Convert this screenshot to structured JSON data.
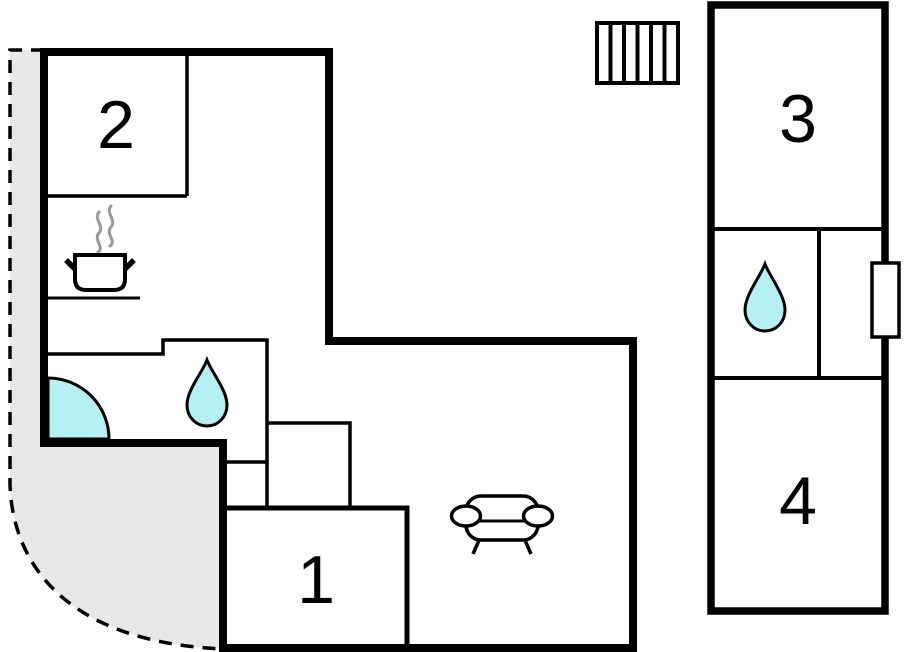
{
  "floorplan": {
    "kind": "vacation-home-floor-plan",
    "rooms": [
      {
        "id": "room-1",
        "label": "1"
      },
      {
        "id": "room-2",
        "label": "2"
      },
      {
        "id": "room-3",
        "label": "3"
      },
      {
        "id": "room-4",
        "label": "4"
      }
    ],
    "icons": [
      {
        "name": "stove-pot-icon"
      },
      {
        "name": "steam-icon"
      },
      {
        "name": "kitchen-counter-line"
      },
      {
        "name": "water-drop-icon-main"
      },
      {
        "name": "water-drop-icon-annex"
      },
      {
        "name": "door-swing-icon"
      },
      {
        "name": "sofa-icon"
      },
      {
        "name": "stairs-icon"
      },
      {
        "name": "window-icon"
      },
      {
        "name": "terrace-dashed-boundary"
      }
    ],
    "colors": {
      "wall": "#000000",
      "water": "#b5f1f3",
      "terrace": "#e8e8e8",
      "steam": "#999999",
      "background": "#ffffff"
    }
  }
}
